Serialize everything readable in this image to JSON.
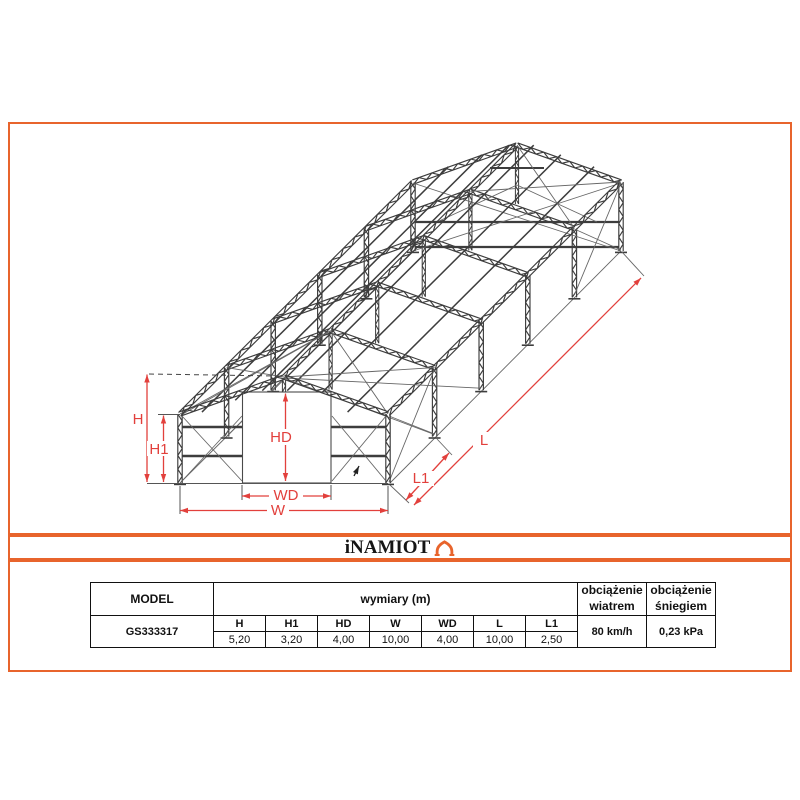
{
  "frame_border_color": "#e8642c",
  "drawing": {
    "labels": {
      "h": "H",
      "h1": "H1",
      "hd": "HD",
      "wd": "WD",
      "w": "W",
      "l": "L",
      "l1": "L1"
    },
    "colors": {
      "member": "#3d3d3d",
      "thin": "#666666",
      "dim_red": "#e2403c"
    }
  },
  "brand": {
    "logo_text": "iNAMIOT"
  },
  "spec_table": {
    "model_header": "MODEL",
    "dimensions_header": "wymiary (m)",
    "wind_header": [
      "obciążenie",
      "wiatrem"
    ],
    "snow_header": [
      "obciążenie",
      "śniegiem"
    ],
    "dim_columns": [
      "H",
      "H1",
      "HD",
      "W",
      "WD",
      "L",
      "L1"
    ],
    "row": {
      "model": "GS333317",
      "values": [
        "5,20",
        "3,20",
        "4,00",
        "10,00",
        "4,00",
        "10,00",
        "2,50"
      ],
      "wind": "80 km/h",
      "snow": "0,23 kPa"
    }
  }
}
